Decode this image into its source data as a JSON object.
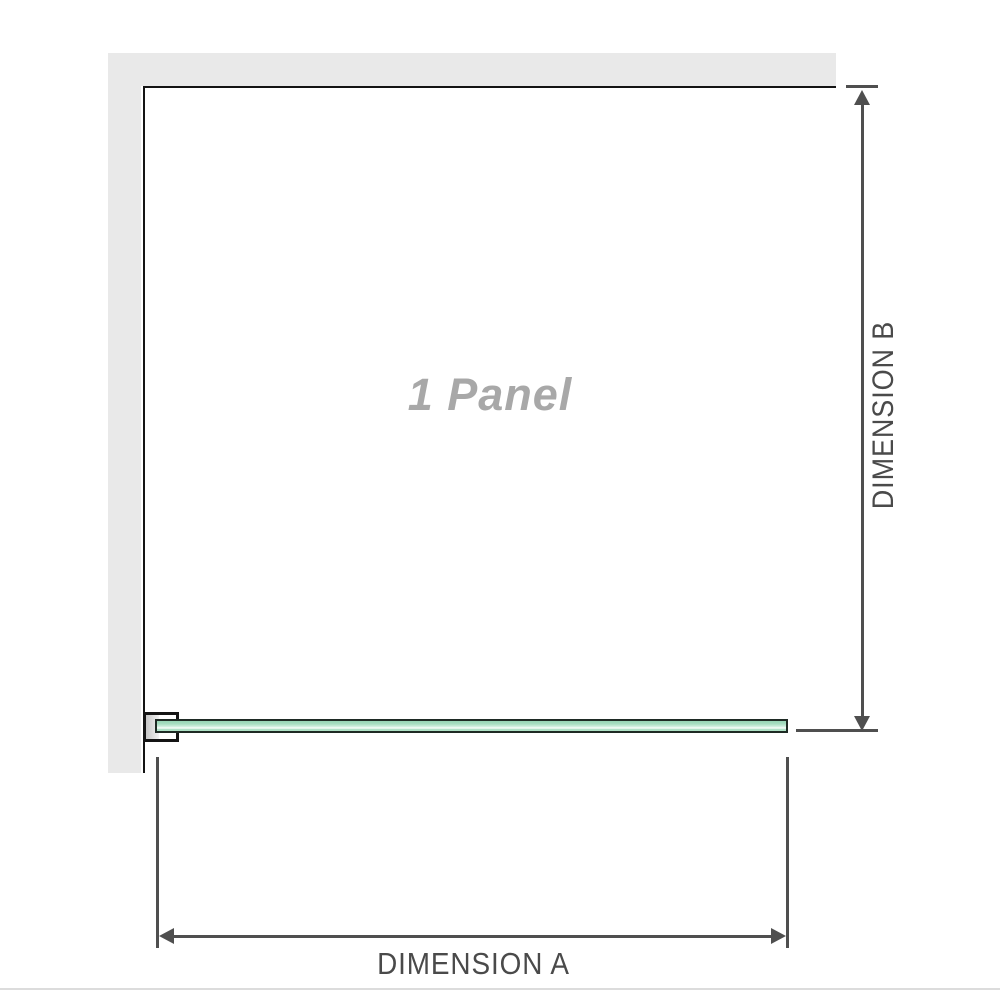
{
  "diagram": {
    "panel_label": "1 Panel",
    "dimension_a_label": "DIMENSION A",
    "dimension_b_label": "DIMENSION B"
  },
  "icons": {
    "arrow_up": "css-triangle-up",
    "arrow_down": "css-triangle-down",
    "arrow_left": "css-triangle-left",
    "arrow_right": "css-triangle-right"
  },
  "colors": {
    "wall": "#e9e9e9",
    "panel_border": "#141414",
    "dimension_line": "#4f4f4f",
    "dimension_text": "#4a4a4a",
    "panel_label_text": "#a8a8a8",
    "glass_border": "#1e2a24",
    "glass_green": "#a6ddc0",
    "glass_green_light": "#cfeede",
    "bracket_shadow": "#c6c6c6",
    "baseline": "#dcdcdc"
  }
}
